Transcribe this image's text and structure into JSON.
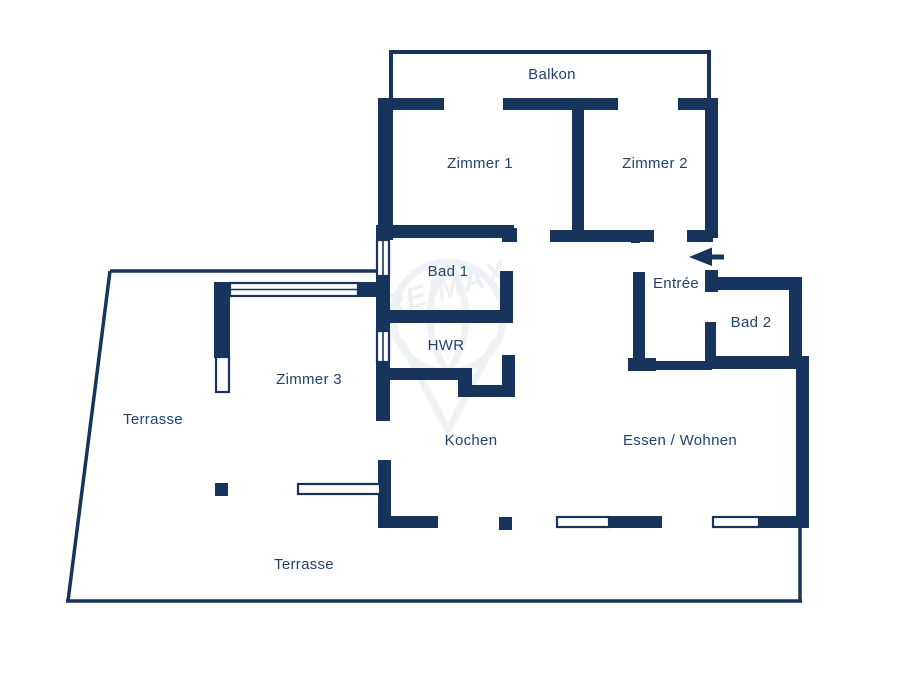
{
  "document": {
    "type": "apartment-floor-plan",
    "language": "de"
  },
  "colors": {
    "wall": "#17345c",
    "label_text": "#21436b",
    "background": "#ffffff",
    "watermark": "#e2e6ec"
  },
  "labels": {
    "balkon": "Balkon",
    "zimmer1": "Zimmer 1",
    "zimmer2": "Zimmer 2",
    "bad1": "Bad 1",
    "hwr": "HWR",
    "entree": "Entrée",
    "bad2": "Bad 2",
    "zimmer3": "Zimmer 3",
    "kochen": "Kochen",
    "essen_wohnen": "Essen  / Wohnen",
    "terrasse_left": "Terrasse",
    "terrasse_bottom": "Terrasse",
    "watermark": "RE/MAX"
  }
}
